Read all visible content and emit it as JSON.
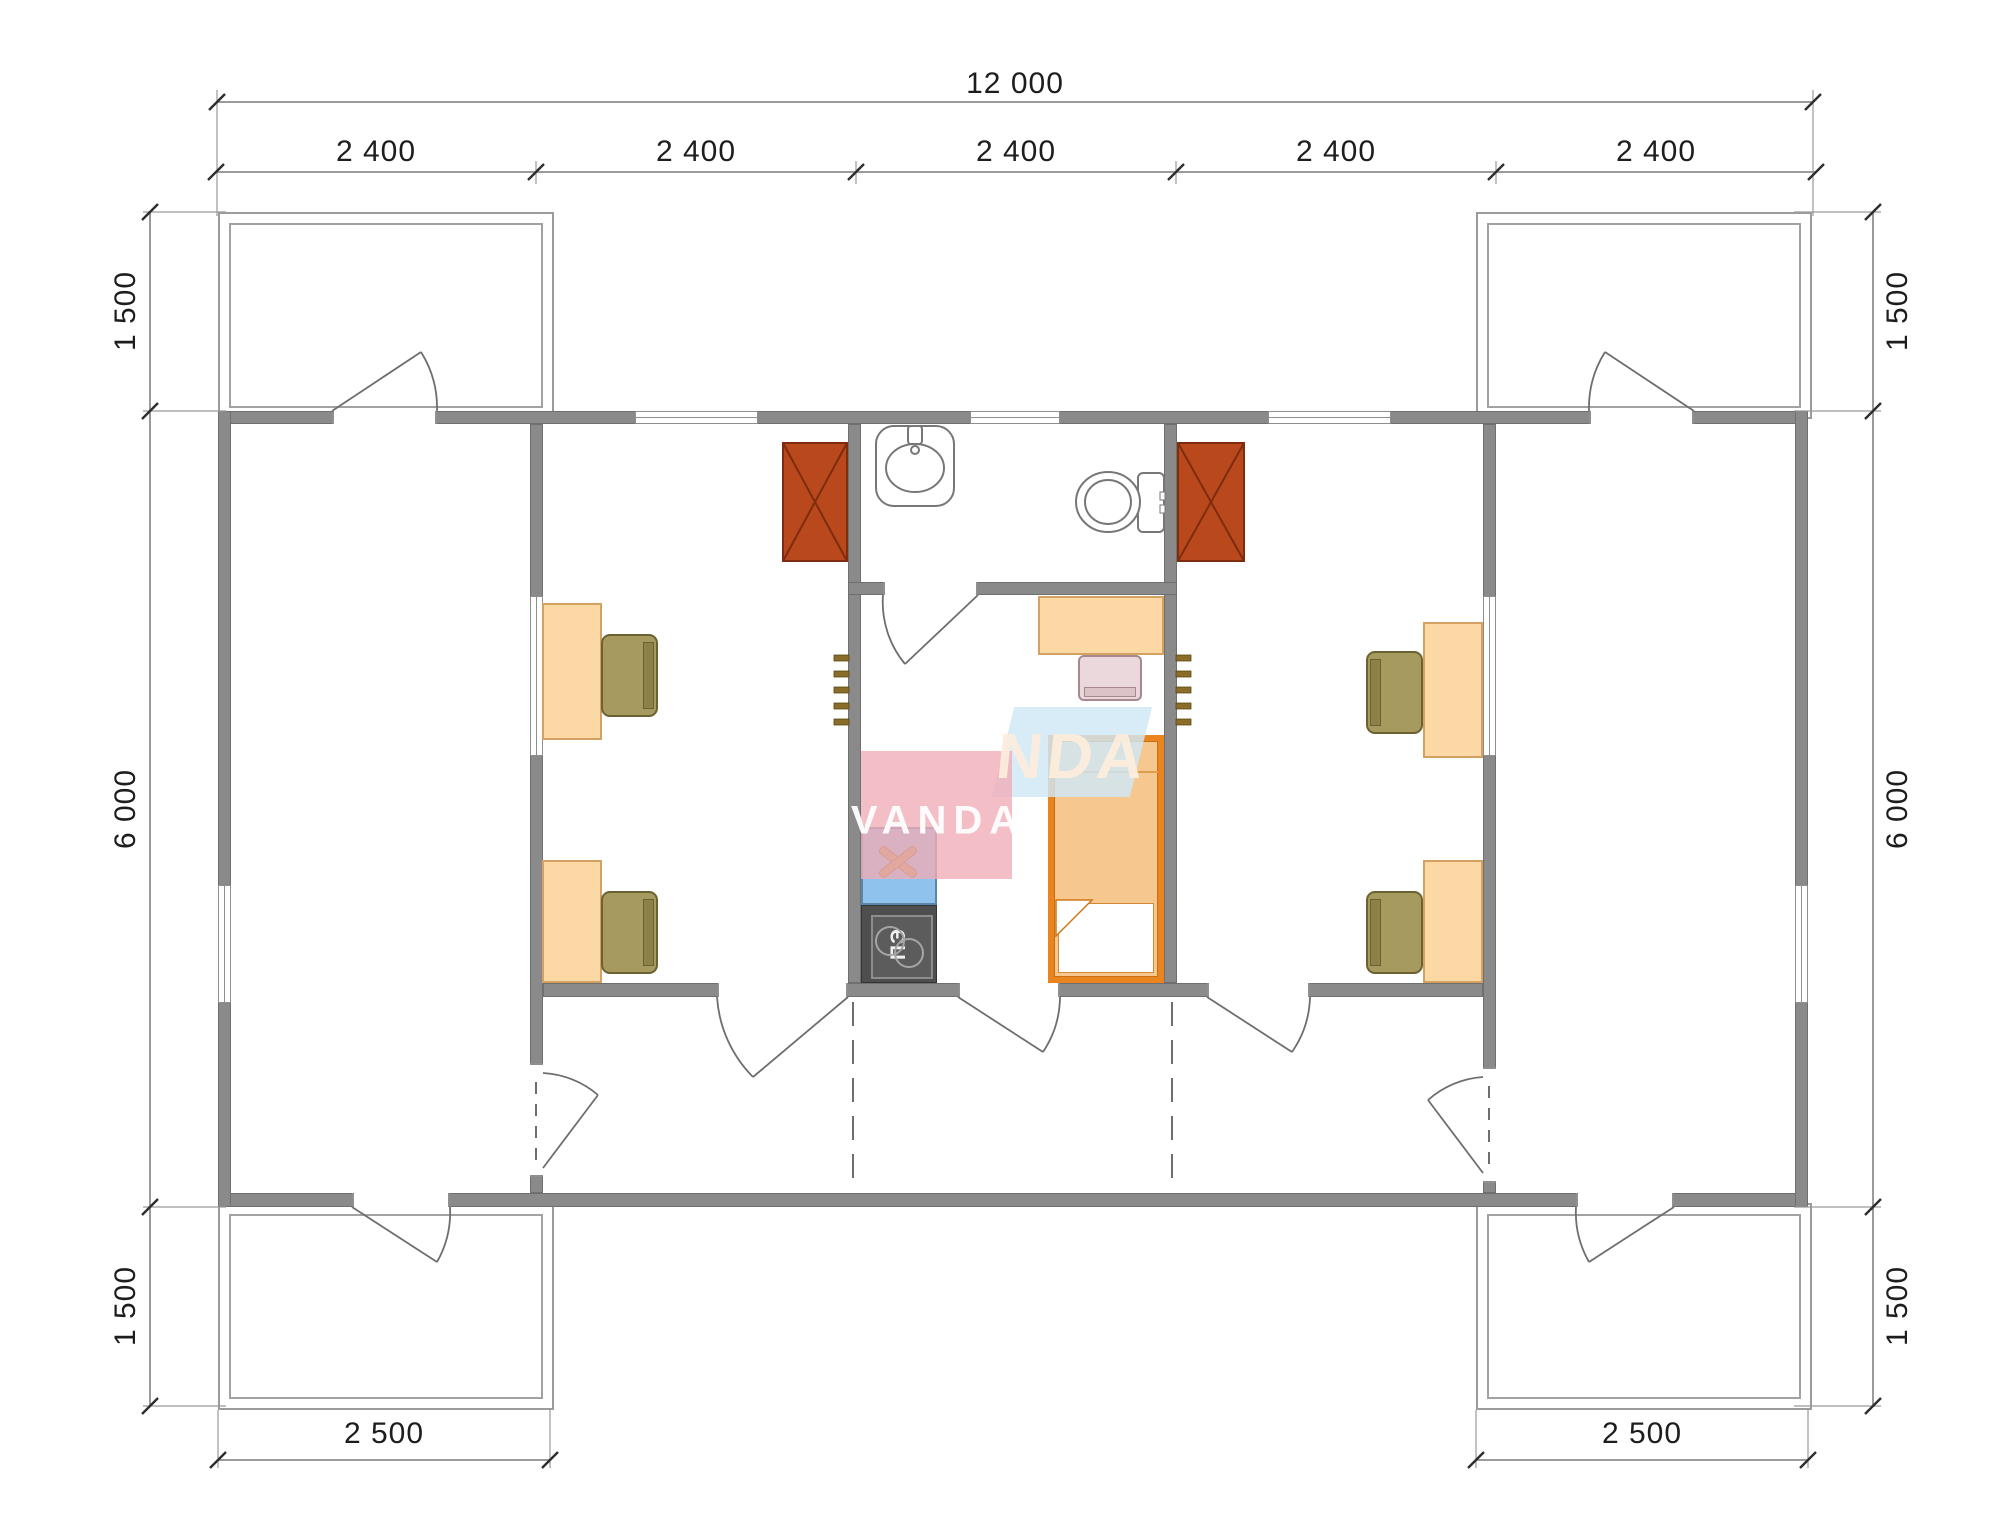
{
  "watermark": {
    "brand_primary": "VANDA",
    "brand_secondary": "NDA"
  },
  "dimensions": {
    "top_total": "12 000",
    "top_modules": [
      "2 400",
      "2 400",
      "2 400",
      "2 400",
      "2 400"
    ],
    "left_top": "1 500",
    "left_middle": "6 000",
    "left_bottom": "1 500",
    "right_top": "1 500",
    "right_middle": "6 000",
    "right_bottom": "1 500",
    "bottom_left_porch": "2 500",
    "bottom_right_porch": "2 500"
  },
  "appliances": {
    "electric_stove_label": "ПЭ"
  },
  "colors": {
    "wall": "#8a8a8a",
    "heater": "#b9481c",
    "desk": "#fcd9a4",
    "chair": "#a69a5e",
    "bed_frame": "#ea841f",
    "kitchen_sink": "#8fc3ee",
    "electric_stove": "#4e4e4e",
    "watermark_pink": "#efacb5",
    "watermark_blue": "#cfe8f6"
  }
}
